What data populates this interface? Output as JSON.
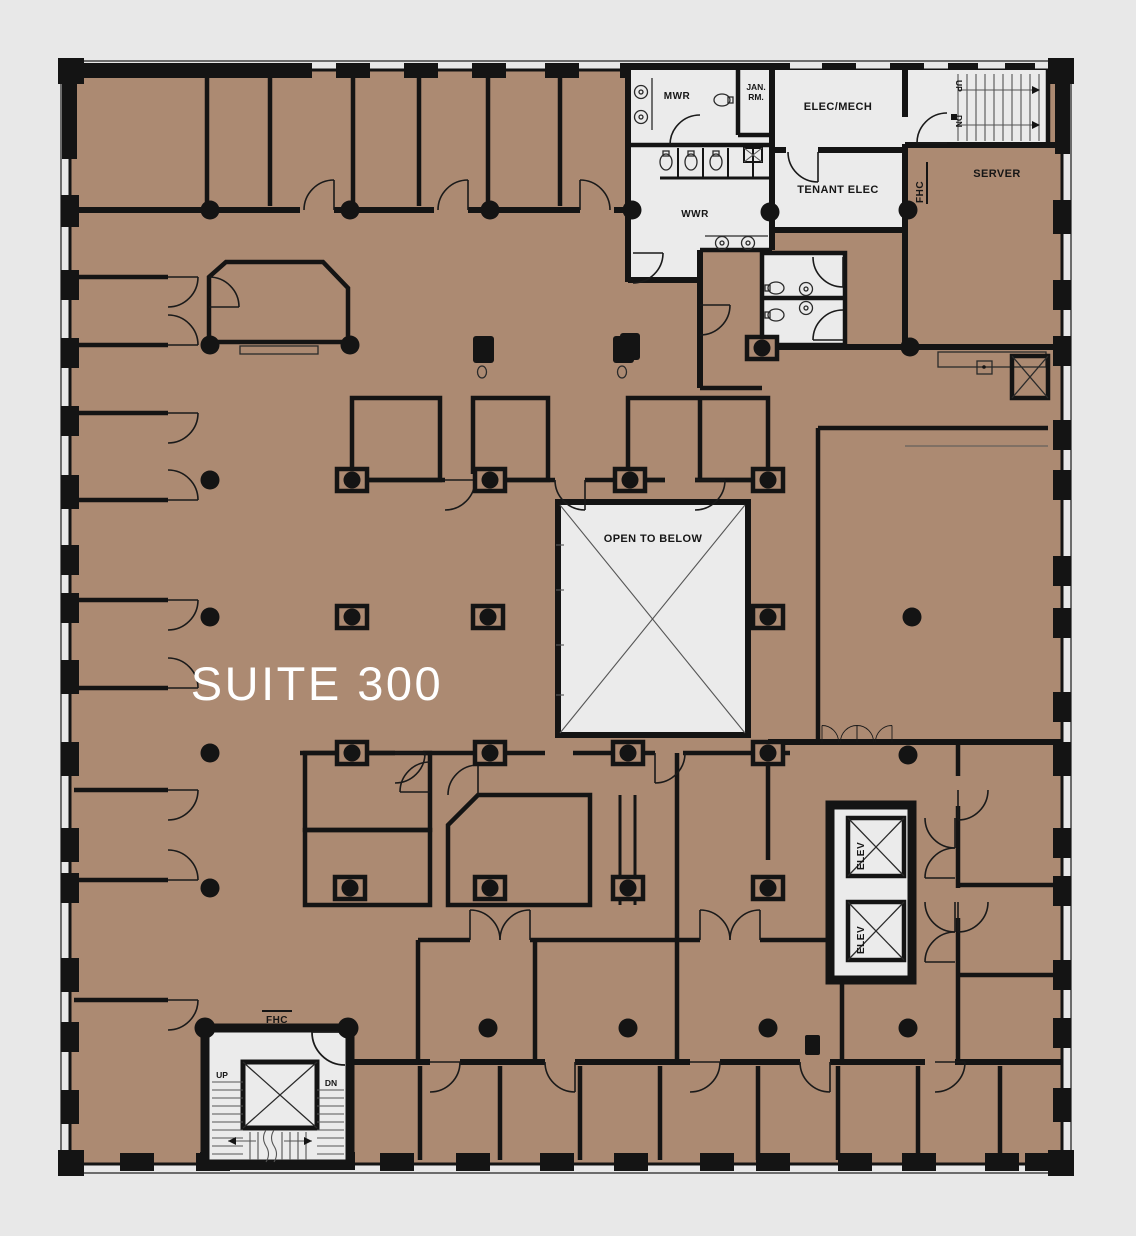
{
  "plan": {
    "suite_label": "SUITE 300",
    "rooms": {
      "mwr": "MWR",
      "jan": "JAN.",
      "rm": "RM.",
      "wwr": "WWR",
      "elec_mech": "ELEC/MECH",
      "tenant_elec": "TENANT ELEC",
      "server": "SERVER",
      "open_to_below": "OPEN TO BELOW",
      "elevator": "ELEV"
    },
    "stairs": {
      "up": "UP",
      "dn": "DN"
    },
    "fire_hose_cabinet": "FHC",
    "colors": {
      "floor": "#ac8a72",
      "room_fill": "#ebebeb",
      "wall": "#141414",
      "background": "#e8e8e8",
      "suite_text": "#ffffff"
    }
  }
}
